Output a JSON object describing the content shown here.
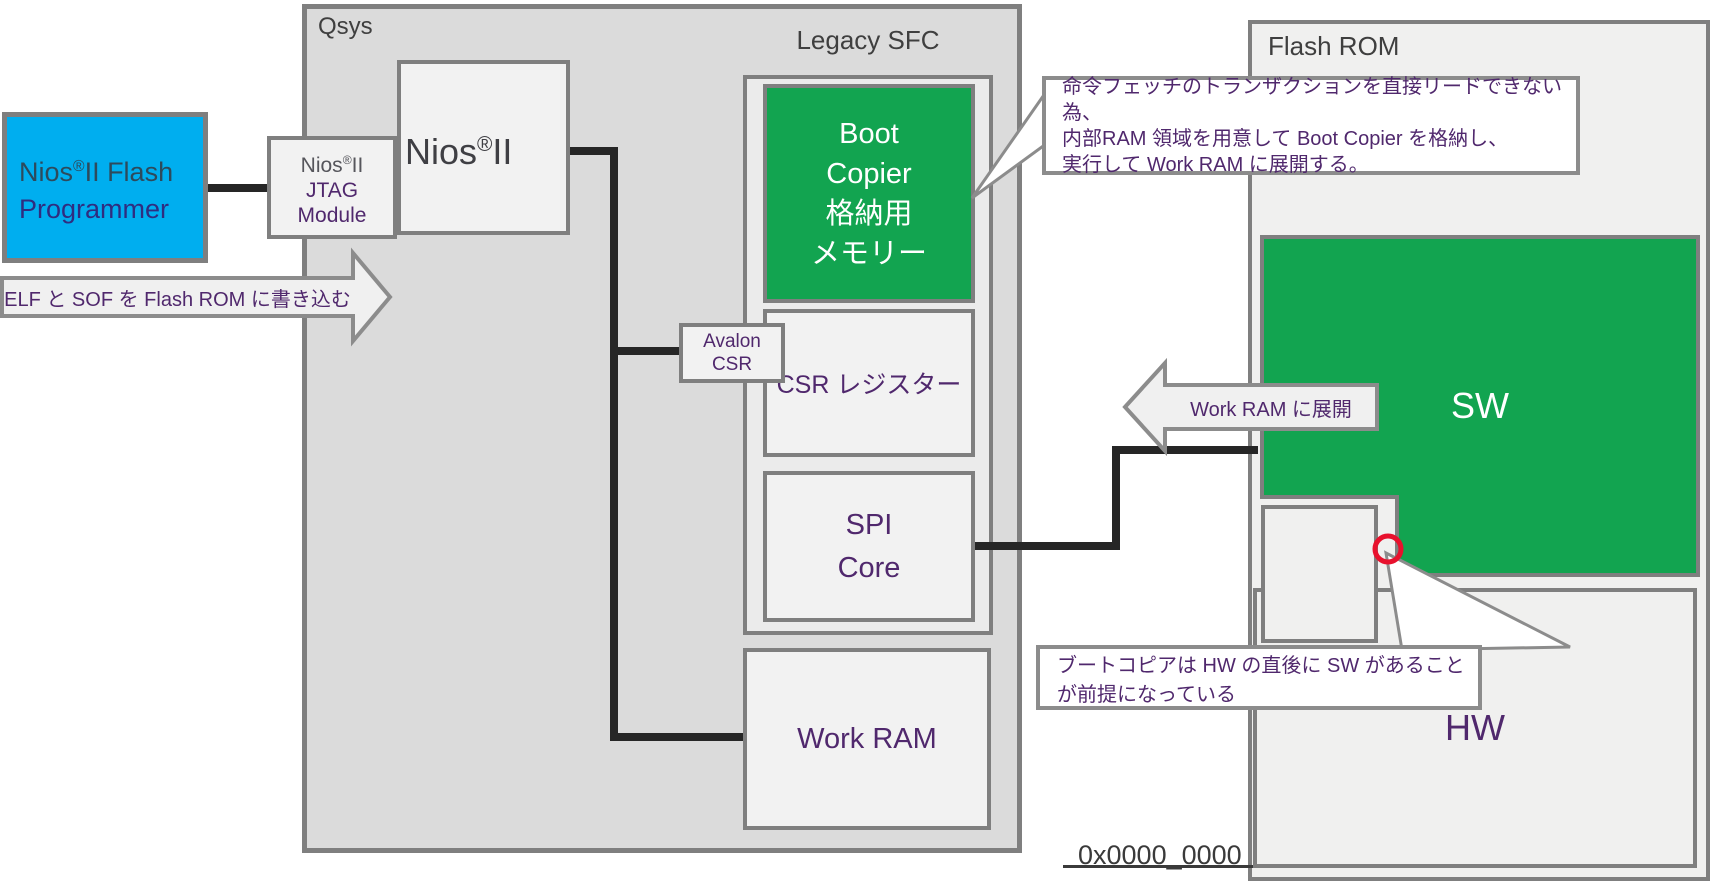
{
  "diagram_title": "Nios II Legacy SFC boot diagram",
  "colors": {
    "accent_green": "#12a450",
    "accent_blue": "#00aeef",
    "purple_text": "#50286d",
    "gray_text": "#3f3f3f",
    "line_black": "#262626",
    "border_gray": "#7f7f7f",
    "red_marker": "#e8112d"
  },
  "containers": {
    "qsys": {
      "label": "Qsys"
    },
    "legacy_sfc": {
      "label": "Legacy SFC"
    },
    "flash_rom": {
      "label": "Flash ROM"
    }
  },
  "flash_programmer": {
    "pre": "Nios",
    "reg": "®",
    "post": "II Flash",
    "line2": "Programmer"
  },
  "jtag_module": {
    "pre": "Nios",
    "reg": "®",
    "post": "II",
    "line2": "JTAG",
    "line3": "Module"
  },
  "nios2": {
    "pre": "Nios",
    "reg": "®",
    "post": "II"
  },
  "boot_copier": {
    "lines": [
      "Boot",
      "Copier",
      "格納用",
      "メモリー"
    ]
  },
  "avalon_csr": {
    "line1": "Avalon",
    "line2": "CSR"
  },
  "csr_register": {
    "label": "CSR レジスター"
  },
  "spi_core": {
    "line1": "SPI",
    "line2": "Core"
  },
  "work_ram": {
    "label": "Work RAM"
  },
  "memory_map": {
    "sw_region": {
      "label": "SW"
    },
    "hw_region": {
      "label": "HW"
    },
    "base_address": {
      "label": "0x0000_0000"
    }
  },
  "arrows": {
    "elf_write": {
      "label": "ELF と SOF を Flash ROM に書き込む"
    },
    "deploy": {
      "label": "Work RAM に展開"
    }
  },
  "callouts": {
    "top": {
      "lines": [
        "命令フェッチのトランザクションを直接リードできない為、",
        "内部RAM 領域を用意して Boot Copier を格納し、",
        "実行して Work RAM に展開する。"
      ]
    },
    "bottom": {
      "label": "ブートコピアは HW の直後に SW があることが前提になっている"
    }
  }
}
